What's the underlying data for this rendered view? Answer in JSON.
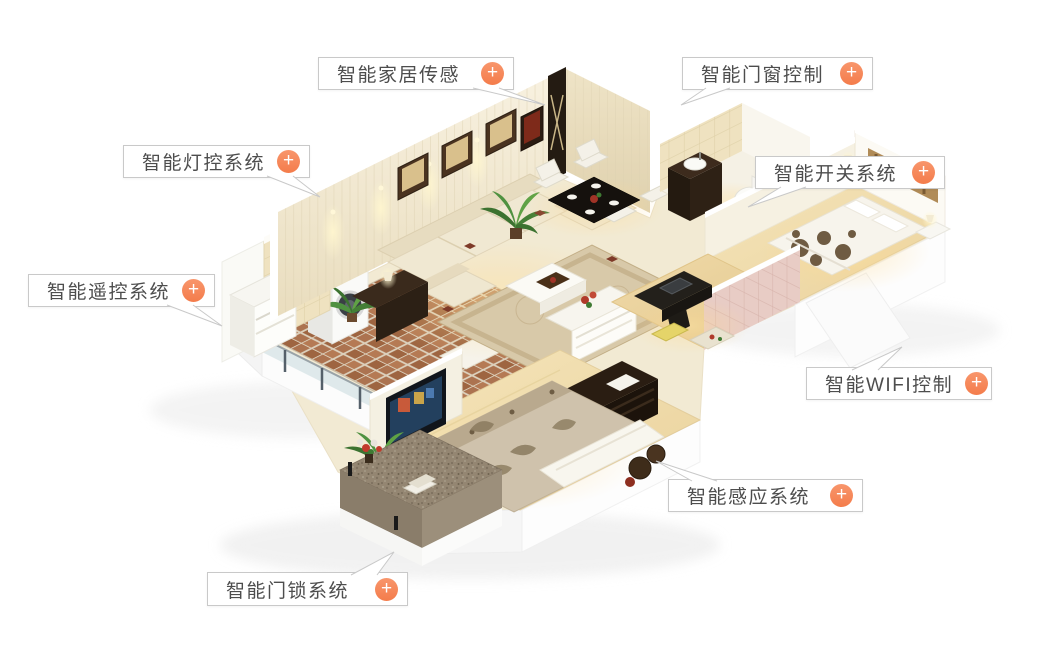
{
  "callouts": [
    {
      "id": "home-sensor",
      "label": "智能家居传感"
    },
    {
      "id": "door-window",
      "label": "智能门窗控制"
    },
    {
      "id": "lighting",
      "label": "智能灯控系统"
    },
    {
      "id": "switch",
      "label": "智能开关系统"
    },
    {
      "id": "remote",
      "label": "智能遥控系统"
    },
    {
      "id": "wifi",
      "label": "智能WIFI控制"
    },
    {
      "id": "sensing",
      "label": "智能感应系统"
    },
    {
      "id": "door-lock",
      "label": "智能门锁系统"
    }
  ],
  "plus_glyph": "+",
  "theme": {
    "accent": "#F5875A",
    "callout_border": "#C9C9C9",
    "callout_text": "#4D4D4D",
    "background": "#FFFFFF"
  }
}
